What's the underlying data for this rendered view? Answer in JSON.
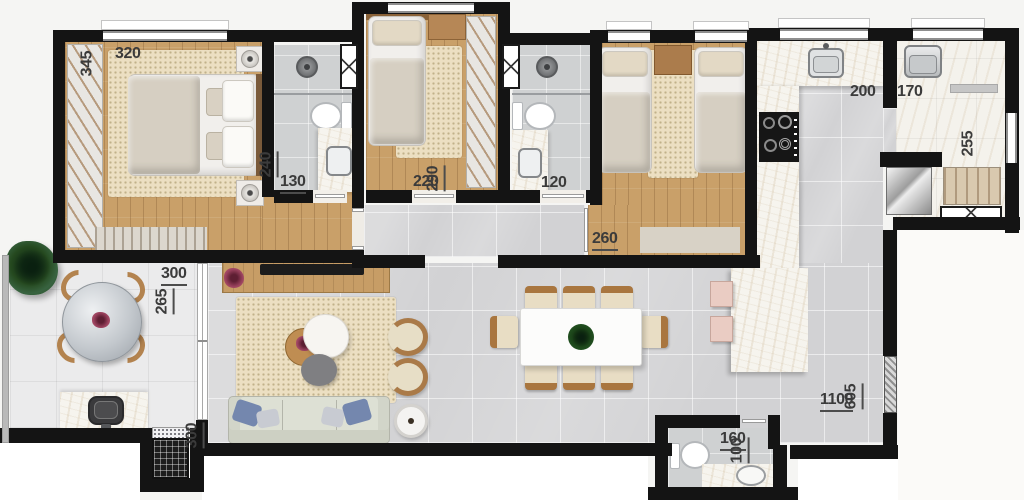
{
  "fp": {
    "title": "apartment-floor-plan",
    "colors": {
      "wall": "#141414",
      "wood_floor": "#c9a069",
      "gray_tile": "#d2d2d4",
      "balcony_tile": "#ebebec",
      "marble_counter": "#f6f4ee",
      "rug_beige": "#ecdfc2",
      "label_text": "#3b3b3b",
      "accent_wood": "#a9763f",
      "pillow_blue": "#7487ae"
    },
    "dims": {
      "master_w": "320",
      "master_h": "345",
      "bath1_h": "240",
      "bath1_w": "130",
      "bed2_w": "220",
      "bed2_h": "290",
      "bath2_w": "120",
      "bed3_w": "260",
      "kitchen_w": "200",
      "laundry_w": "170",
      "laundry_h": "255",
      "balcony_w": "300",
      "balcony_h": "265",
      "living_wall_h": "300",
      "social_w": "1100",
      "social_h": "605",
      "powder_w": "160",
      "powder_h": "100"
    }
  }
}
